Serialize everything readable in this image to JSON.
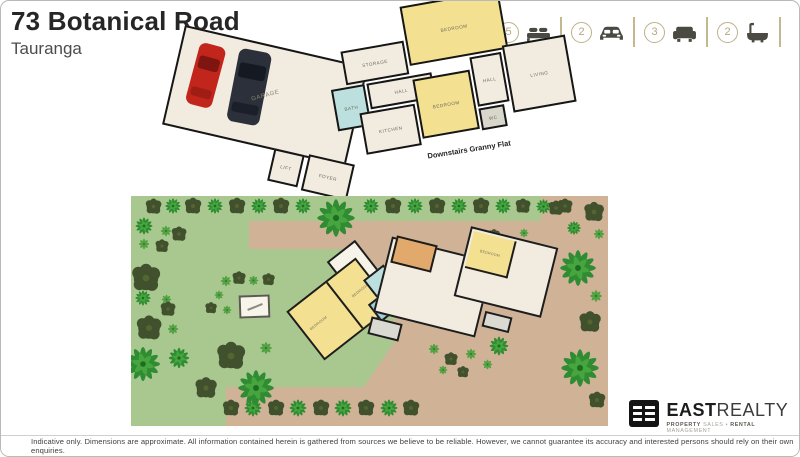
{
  "header": {
    "title": "73 Botanical Road",
    "subtitle": "Tauranga"
  },
  "stats": {
    "bedrooms": "5",
    "garages": "2",
    "living_rooms": "3",
    "bathrooms": "2"
  },
  "floorplan": {
    "caption": "Downstairs Granny Flat",
    "rooms": {
      "garage": "GARAGE",
      "foyer": "FOYER",
      "lift": "LIFT",
      "storage": "STORAGE",
      "bath": "BATH",
      "hall_upper": "HALL",
      "bedroom_upper": "BEDROOM",
      "bedroom_lower": "BEDROOM",
      "hall_lower": "HALL",
      "living": "LIVING",
      "kitchen": "KITCHEN",
      "wc": "WC"
    }
  },
  "siteplan": {
    "house_rooms": {
      "bedroom_main": "BEDROOM",
      "bedroom_left": "BEDROOM",
      "bedroom_right": "BEDROOM"
    }
  },
  "logo": {
    "name_bold": "EAST",
    "name_light": "REALTY",
    "tagline_parts": {
      "b1": "PROPERTY",
      "l1": "SALES",
      "sep": "•",
      "b2": "RENTAL",
      "l2": "MANAGEMENT"
    }
  },
  "footer": {
    "disclaimer": "Indicative only. Dimensions are approximate. All information contained herein is gathered from sources we believe to be reliable. However, we cannot guarantee its accuracy and interested persons should rely on their own enquiries."
  },
  "colors": {
    "accent_olive": "#bcb187",
    "lawn_green": "#a9c88f",
    "driveway_tan": "#d0b297",
    "bedroom_yellow": "#f3e191",
    "bath_teal": "#bce0de",
    "floor_cream": "#f1ecdf",
    "wall": "#161616"
  }
}
